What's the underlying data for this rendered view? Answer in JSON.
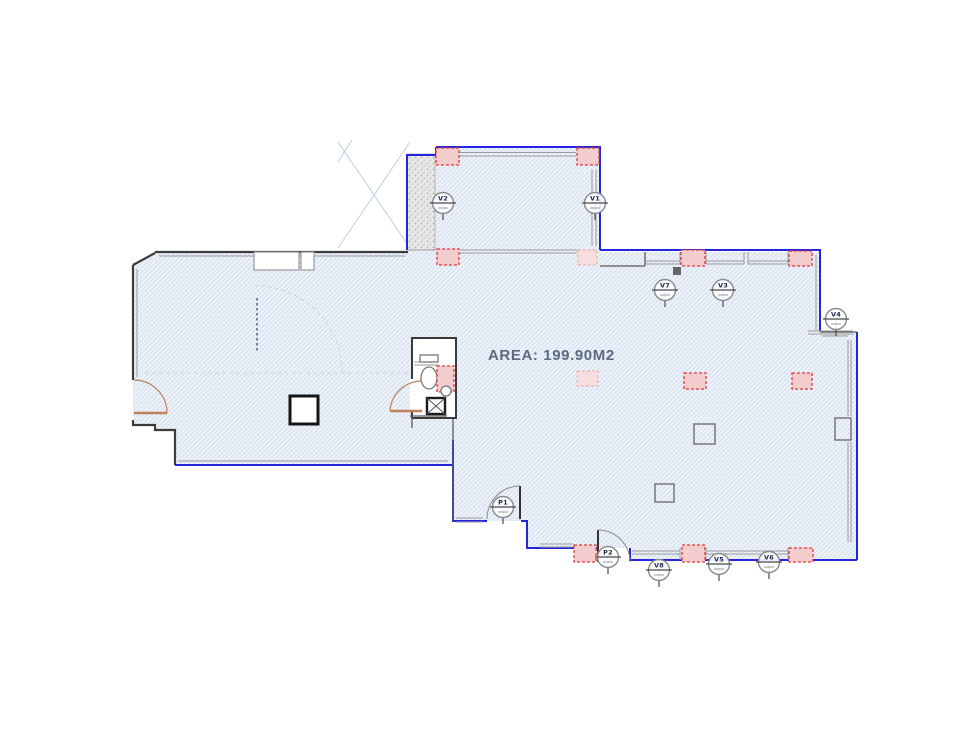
{
  "drawing": {
    "area_label": "AREA: 199.90M2"
  },
  "markers": {
    "v1": {
      "label": "V1"
    },
    "v2": {
      "label": "V2"
    },
    "v3": {
      "label": "V3"
    },
    "v4": {
      "label": "V4"
    },
    "v5": {
      "label": "V5"
    },
    "v6": {
      "label": "V6"
    },
    "v7": {
      "label": "V7"
    },
    "v8": {
      "label": "V8"
    },
    "p1": {
      "label": "P1"
    },
    "p2": {
      "label": "P2"
    }
  },
  "colors": {
    "blue-boundary": "#2525dd",
    "wall-dark": "#3c3c3c",
    "wall-grey": "#9a9a9a",
    "hatch-line": "#cbd9ec",
    "floor-fill": "#eef3fa",
    "column-fill": "#f3cdcd",
    "column-border": "#e23a3a",
    "door-orange": "#c0825c",
    "area-text": "#5d6b80",
    "marker-stroke": "#8a8a8a",
    "marker-label": "#1a2648",
    "faint-line": "#bdd0e0",
    "stipple-bg": "#e8e8e8"
  }
}
